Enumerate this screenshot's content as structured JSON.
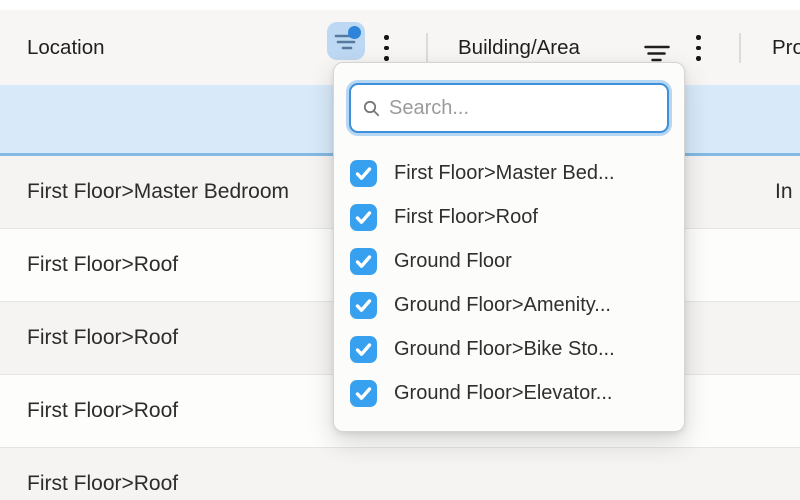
{
  "header": {
    "columns": {
      "location": "Location",
      "building_area": "Building/Area",
      "product_partial": "Pro"
    },
    "location_filter_active": true,
    "building_filter_active": false
  },
  "filter_dropdown": {
    "search": {
      "placeholder": "Search...",
      "value": ""
    },
    "options": [
      {
        "label": "First Floor>Master Bed...",
        "checked": true
      },
      {
        "label": "First Floor>Roof",
        "checked": true
      },
      {
        "label": "Ground Floor",
        "checked": true
      },
      {
        "label": "Ground Floor>Amenity...",
        "checked": true
      },
      {
        "label": "Ground Floor>Bike Sto...",
        "checked": true
      },
      {
        "label": "Ground Floor>Elevator...",
        "checked": true
      }
    ]
  },
  "table": {
    "highlighted_row": {
      "location": "",
      "status": ""
    },
    "rows": [
      {
        "location": "First Floor>Master Bedroom",
        "status": "In P"
      },
      {
        "location": "First Floor>Roof",
        "status": ""
      },
      {
        "location": "First Floor>Roof",
        "status": ""
      },
      {
        "location": "First Floor>Roof",
        "status": ""
      },
      {
        "location": "First Floor>Roof",
        "status": ""
      }
    ]
  },
  "colors": {
    "accent_blue": "#38a1ef",
    "filter_button_bg": "#bdd8f2",
    "filter_dot": "#2e84d9",
    "highlighted_row_bg": "#d8eafa",
    "highlighted_row_border": "#83bae3",
    "focus_ring": "#3f90da"
  }
}
